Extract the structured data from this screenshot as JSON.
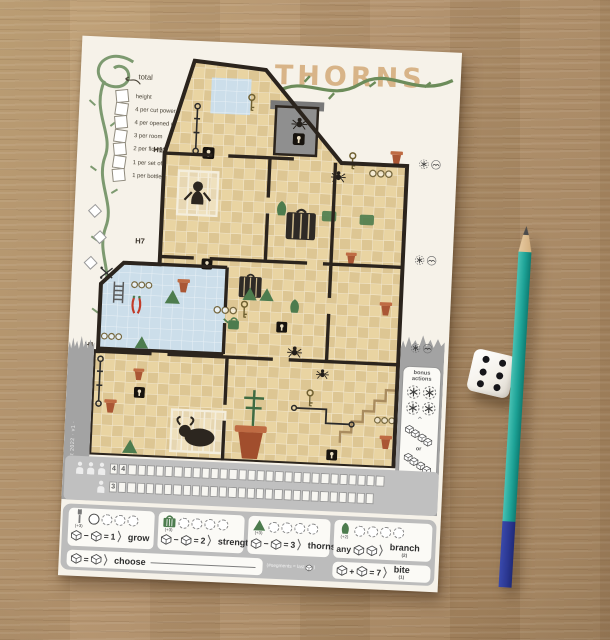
{
  "photo": {
    "die": {
      "value": 6
    },
    "pencil": {
      "body_color": "#1da296",
      "end_color": "#2b3791"
    }
  },
  "paper": {
    "title": "THORNS",
    "scoring": {
      "total_label": "total",
      "items": [
        "height",
        "4 per cut power cable",
        "4 per opened cage",
        "3 per room",
        "2 per flower pot",
        "1 per set of bottles",
        "1 per bottle"
      ]
    },
    "height_markers": [
      "H13",
      "H7",
      "H1"
    ],
    "credit": "· august 2022 · v1 ·",
    "bonus_box": {
      "title_line1": "bonus",
      "title_line2": "actions",
      "flowers": 4,
      "chain_length": 4,
      "or_label": "or"
    },
    "tracks": [
      {
        "persons": 3,
        "cells": 30,
        "values": [
          "4",
          "4"
        ]
      },
      {
        "persons": 1,
        "cells": 29,
        "values": [
          "3"
        ]
      }
    ],
    "rules": {
      "boxes": [
        {
          "icon": "cable",
          "bonus": "(+3)",
          "circles": 4,
          "first_marked": true,
          "op": "−",
          "eq": "=",
          "num": "1",
          "label": "grow"
        },
        {
          "icon": "cage",
          "bonus": "(+3)",
          "circles": 4,
          "first_marked": false,
          "op": "−",
          "eq": "=",
          "num": "2",
          "label": "strength"
        },
        {
          "icon": "thorn",
          "bonus": "(+3)",
          "circles": 4,
          "first_marked": false,
          "op": "−",
          "eq": "=",
          "num": "3",
          "label": "thorns"
        },
        {
          "icon": "bush",
          "bonus": "(+2)",
          "circles": 4,
          "first_marked": false,
          "any_label": "any",
          "label": "branch",
          "sub": "(2)"
        }
      ],
      "choose": {
        "op": "=",
        "label": "choose"
      },
      "segments_note_prefix": "(#segments = last",
      "segments_note_suffix": ")",
      "bite": {
        "op": "+",
        "eq": "=",
        "num": "7",
        "label": "bite",
        "sub": "(1)"
      }
    },
    "map": {
      "icons": [
        {
          "t": "cageplant",
          "x": 94,
          "y": 4,
          "w": 34,
          "h": 36
        },
        {
          "t": "key",
          "x": 142,
          "y": 34,
          "w": 10,
          "h": 20
        },
        {
          "t": "key",
          "x": 246,
          "y": 88,
          "w": 10,
          "h": 20
        },
        {
          "t": "key",
          "x": 144,
          "y": 242,
          "w": 10,
          "h": 20
        },
        {
          "t": "key",
          "x": 214,
          "y": 328,
          "w": 10,
          "h": 20
        },
        {
          "t": "lock",
          "x": 100,
          "y": 90,
          "w": 12,
          "h": 12
        },
        {
          "t": "lock",
          "x": 190,
          "y": 72,
          "w": 12,
          "h": 12
        },
        {
          "t": "lock",
          "x": 104,
          "y": 202,
          "w": 11,
          "h": 11
        },
        {
          "t": "lock",
          "x": 182,
          "y": 262,
          "w": 11,
          "h": 11
        },
        {
          "t": "lock",
          "x": 42,
          "y": 334,
          "w": 11,
          "h": 11
        },
        {
          "t": "lock",
          "x": 238,
          "y": 388,
          "w": 11,
          "h": 11
        },
        {
          "t": "spider",
          "x": 188,
          "y": 54,
          "w": 16,
          "h": 16
        },
        {
          "t": "spider",
          "x": 230,
          "y": 106,
          "w": 15,
          "h": 15
        },
        {
          "t": "spider",
          "x": 194,
          "y": 284,
          "w": 15,
          "h": 15
        },
        {
          "t": "spider",
          "x": 224,
          "y": 306,
          "w": 13,
          "h": 13
        },
        {
          "t": "monkeycage",
          "x": 76,
          "y": 112,
          "w": 42,
          "h": 48
        },
        {
          "t": "cage",
          "x": 184,
          "y": 146,
          "w": 36,
          "h": 34
        },
        {
          "t": "cage",
          "x": 140,
          "y": 214,
          "w": 28,
          "h": 26
        },
        {
          "t": "bullcage",
          "x": 80,
          "y": 354,
          "w": 56,
          "h": 44
        },
        {
          "t": "bigpot",
          "x": 140,
          "y": 366,
          "w": 42,
          "h": 36
        },
        {
          "t": "plantcross",
          "x": 150,
          "y": 328,
          "w": 26,
          "h": 40
        },
        {
          "t": "pot",
          "x": 78,
          "y": 222,
          "w": 18,
          "h": 16
        },
        {
          "t": "pot",
          "x": 286,
          "y": 84,
          "w": 18,
          "h": 16
        },
        {
          "t": "pot",
          "x": 282,
          "y": 236,
          "w": 18,
          "h": 16
        },
        {
          "t": "pot",
          "x": 10,
          "y": 346,
          "w": 18,
          "h": 16
        },
        {
          "t": "pot",
          "x": 246,
          "y": 188,
          "w": 16,
          "h": 14
        },
        {
          "t": "pot",
          "x": 38,
          "y": 314,
          "w": 16,
          "h": 14
        },
        {
          "t": "pot",
          "x": 288,
          "y": 370,
          "w": 18,
          "h": 16
        },
        {
          "t": "tri",
          "x": 68,
          "y": 234,
          "w": 17,
          "h": 16
        },
        {
          "t": "tri",
          "x": 40,
          "y": 282,
          "w": 15,
          "h": 14
        },
        {
          "t": "tri",
          "x": 146,
          "y": 228,
          "w": 16,
          "h": 15
        },
        {
          "t": "tri",
          "x": 163,
          "y": 228,
          "w": 16,
          "h": 15
        },
        {
          "t": "tri",
          "x": 32,
          "y": 386,
          "w": 17,
          "h": 16
        },
        {
          "t": "bottles",
          "x": 268,
          "y": 104,
          "w": 24,
          "h": 10
        },
        {
          "t": "bottles",
          "x": 118,
          "y": 248,
          "w": 24,
          "h": 10
        },
        {
          "t": "bottles",
          "x": 34,
          "y": 227,
          "w": 22,
          "h": 9
        },
        {
          "t": "bottles",
          "x": 284,
          "y": 352,
          "w": 22,
          "h": 9
        },
        {
          "t": "bottles",
          "x": 6,
          "y": 280,
          "w": 22,
          "h": 9
        },
        {
          "t": "ladder",
          "x": 14,
          "y": 228,
          "w": 16,
          "h": 24
        },
        {
          "t": "chili",
          "x": 34,
          "y": 242,
          "w": 13,
          "h": 20
        },
        {
          "t": "can",
          "x": 128,
          "y": 258,
          "w": 20,
          "h": 15
        },
        {
          "t": "bush",
          "x": 174,
          "y": 140,
          "w": 16,
          "h": 17
        },
        {
          "t": "bush",
          "x": 192,
          "y": 238,
          "w": 15,
          "h": 16
        },
        {
          "t": "greensq",
          "x": 222,
          "y": 148,
          "w": 16,
          "h": 12
        },
        {
          "t": "greensq",
          "x": 260,
          "y": 150,
          "w": 16,
          "h": 12
        },
        {
          "t": "cablev",
          "x": 88,
          "y": 46,
          "w": 10,
          "h": 52
        },
        {
          "t": "cablev",
          "x": 2,
          "y": 304,
          "w": 10,
          "h": 52
        },
        {
          "t": "cableh",
          "x": 200,
          "y": 344,
          "w": 66,
          "h": 22
        },
        {
          "t": "cut",
          "x": 2,
          "y": 214,
          "w": 14,
          "h": 14
        }
      ]
    }
  }
}
